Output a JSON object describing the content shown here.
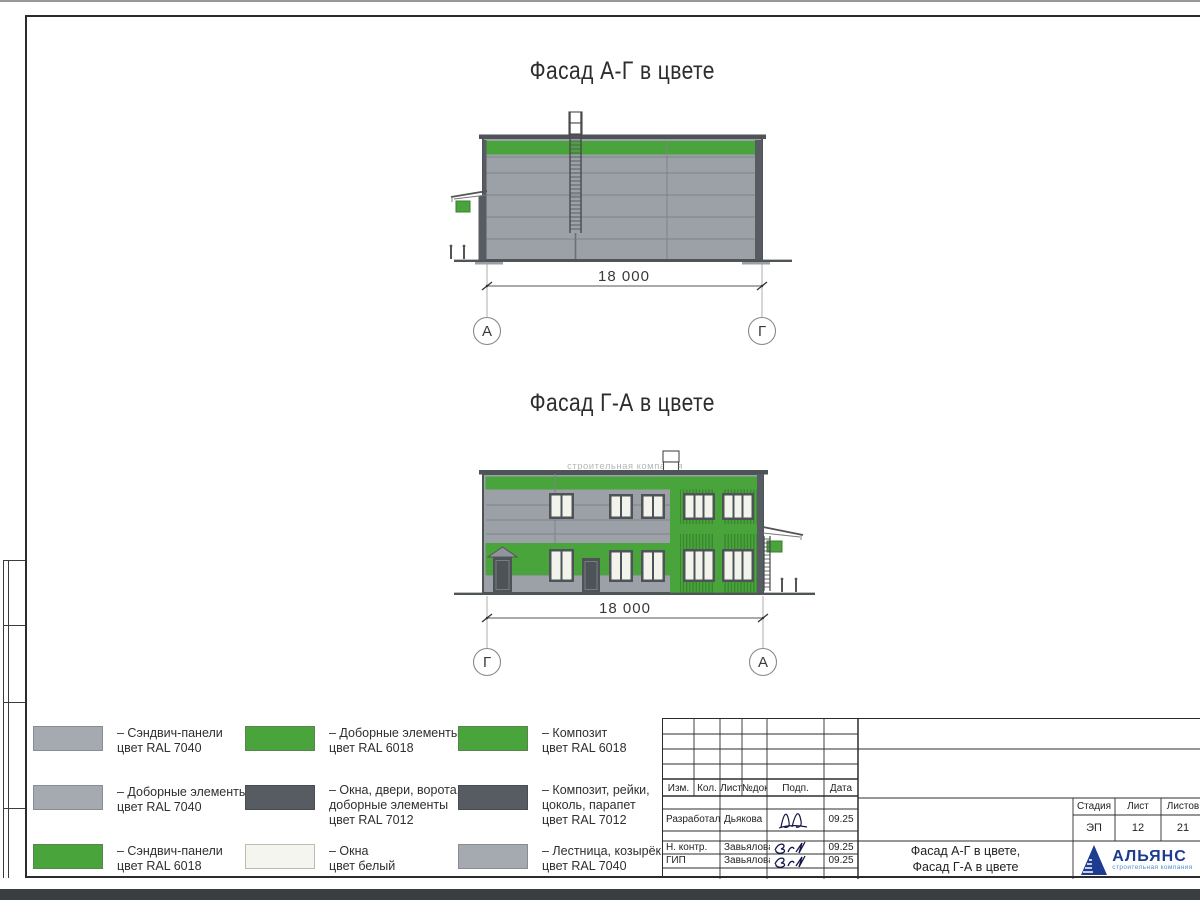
{
  "colors": {
    "green": "#4aa43c",
    "green-dark": "#37862c",
    "panel": "#9ba1a7",
    "panel-line": "#7e8488",
    "dark": "#565c61",
    "frame": "#4d5357",
    "window": "#f2f4ec",
    "swatch-gray": "#a5aab0",
    "swatch-white": "#f3f5ee",
    "logo-navy": "#1d3b8f",
    "logo-blue": "#4f8fd0",
    "bottom-bar": "#3b3e41"
  },
  "facade1": {
    "title": "Фасад А-Г в цвете",
    "dimension": "18 000",
    "axis_left": "А",
    "axis_right": "Г"
  },
  "facade2": {
    "title": "Фасад Г-А в цвете",
    "dimension": "18 000",
    "axis_left": "Г",
    "axis_right": "А",
    "watermark": "строительная компания"
  },
  "legend": {
    "items": [
      {
        "color_key": "gray",
        "lines": [
          "– Сэндвич-панели",
          "цвет RAL 7040"
        ]
      },
      {
        "color_key": "gray",
        "lines": [
          "– Доборные элементы",
          "цвет RAL 7040"
        ]
      },
      {
        "color_key": "green",
        "lines": [
          "– Сэндвич-панели",
          "цвет RAL 6018"
        ]
      },
      {
        "color_key": "green",
        "lines": [
          "– Доборные элементы",
          "цвет RAL 6018"
        ]
      },
      {
        "color_key": "dark",
        "lines": [
          "– Окна, двери, ворота,",
          "доборные элементы",
          "цвет RAL 7012"
        ]
      },
      {
        "color_key": "white",
        "lines": [
          "– Окна",
          "цвет белый"
        ]
      },
      {
        "color_key": "green",
        "lines": [
          "– Композит",
          "цвет RAL 6018"
        ]
      },
      {
        "color_key": "dark",
        "lines": [
          "– Композит, рейки,",
          "цоколь, парапет",
          "цвет RAL 7012"
        ]
      },
      {
        "color_key": "gray",
        "lines": [
          "– Лестница, козырёк",
          "цвет RAL 7040"
        ]
      }
    ]
  },
  "titleblock": {
    "header_cols": [
      "Изм.",
      "Кол.",
      "Лист",
      "№док",
      "Подп.",
      "Дата"
    ],
    "sign_rows": [
      {
        "role": "Разработал",
        "name": "Дьякова",
        "date": "09.25"
      },
      {
        "role": "Н. контр.",
        "name": "Завьялова",
        "date": "09.25"
      },
      {
        "role": "ГИП",
        "name": "Завьялова",
        "date": "09.25"
      }
    ],
    "stage_label": "Стадия",
    "stage_value": "ЭП",
    "sheet_label": "Лист",
    "sheet_value": "12",
    "sheets_label": "Листов",
    "sheets_value": "21",
    "doc_title_line1": "Фасад А-Г в цвете,",
    "doc_title_line2": "Фасад Г-А в цвете",
    "logo_name": "АЛЬЯНС",
    "logo_subtitle": "строительная компания"
  }
}
